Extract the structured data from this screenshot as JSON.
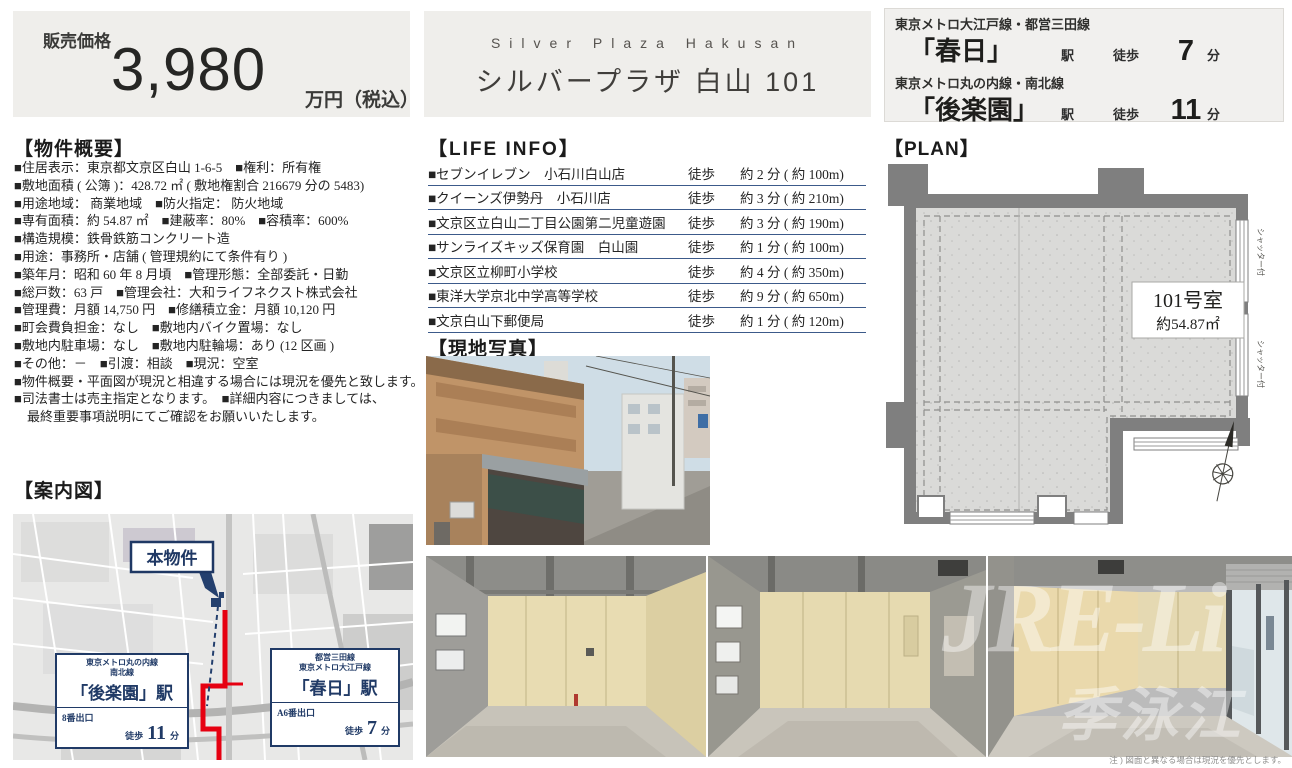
{
  "price": {
    "label": "販売価格",
    "amount": "3,980",
    "unit": "万円（税込）"
  },
  "title": {
    "en": "Silver Plaza Hakusan",
    "ja": "シルバープラザ 白山 101"
  },
  "access": [
    {
      "line": "東京メトロ大江戸線・都営三田線",
      "station": "「春日」",
      "eki": "駅",
      "walk": "徒歩",
      "minutes": "7",
      "unit": "分"
    },
    {
      "line": "東京メトロ丸の内線・南北線",
      "station": "「後楽園」",
      "eki": "駅",
      "walk": "徒歩",
      "minutes": "11",
      "unit": "分"
    }
  ],
  "outline": {
    "heading": "【物件概要】",
    "lines": [
      "■住居表示：東京都文京区白山 1-6-5　■権利：所有権",
      "■敷地面積 ( 公簿 )：428.72 ㎡ ( 敷地権割合 216679 分の 5483)",
      "■用途地域： 商業地域　■防火指定： 防火地域",
      "■専有面積：約 54.87 ㎡　■建蔽率：80%　■容積率：600%",
      "■構造規模：鉄骨鉄筋コンクリート造",
      "■用途：事務所・店舗 ( 管理規約にて条件有り )",
      "■築年月：昭和 60 年 8 月頃　■管理形態：全部委託・日勤",
      "■総戸数：63 戸　■管理会社：大和ライフネクスト株式会社",
      "■管理費：月額 14,750 円　■修繕積立金：月額 10,120 円",
      "■町会費負担金：なし　■敷地内バイク置場：なし",
      "■敷地内駐車場：なし　■敷地内駐輪場：あり (12 区画 )",
      "■その他：－　■引渡：相談　■現況：空室",
      "■物件概要・平面図が現況と相違する場合には現況を優先と致します。",
      "■司法書士は売主指定となります。　■詳細内容につきましては、",
      "　最終重要事項説明にてご確認をお願いいたします。"
    ]
  },
  "life_info": {
    "heading": "【LIFE INFO】",
    "rows": [
      {
        "name": "■セブンイレブン　小石川白山店",
        "walk": "徒歩",
        "time": "約 2 分 ( 約 100m)"
      },
      {
        "name": "■クイーンズ伊勢丹　小石川店",
        "walk": "徒歩",
        "time": "約 3 分 ( 約 210m)"
      },
      {
        "name": "■文京区立白山二丁目公園第二児童遊園",
        "walk": "徒歩",
        "time": "約 3 分 ( 約 190m)"
      },
      {
        "name": "■サンライズキッズ保育園　白山園",
        "walk": "徒歩",
        "time": "約 1 分 ( 約 100m)"
      },
      {
        "name": "■文京区立柳町小学校",
        "walk": "徒歩",
        "time": "約 4 分 ( 約 350m)"
      },
      {
        "name": "■東洋大学京北中学高等学校",
        "walk": "徒歩",
        "time": "約 9 分 ( 約 650m)"
      },
      {
        "name": "■文京白山下郵便局",
        "walk": "徒歩",
        "time": "約 1 分 ( 約 120m)"
      }
    ]
  },
  "photos": {
    "heading": "【現地写真】",
    "watermark_latin": "JRE-Li",
    "watermark_cjk": "季泳江",
    "caption": "注 ) 図面と異なる場合は現況を優先とします。"
  },
  "plan": {
    "heading": "【PLAN】",
    "room_label": "101号室",
    "room_area": "約54.87㎡",
    "shutter_label": "シャッター付"
  },
  "map": {
    "heading": "【案内図】",
    "property_label": "本物件",
    "stations": [
      {
        "line1": "東京メトロ丸の内線",
        "line2": "南北線",
        "name": "「後楽園」駅",
        "exit": "8番出口",
        "walk": "徒歩",
        "minutes": "11",
        "unit": "分"
      },
      {
        "line1": "都営三田線",
        "line2": "東京メトロ大江戸線",
        "name": "「春日」駅",
        "exit": "A6番出口",
        "walk": "徒歩",
        "minutes": "7",
        "unit": "分"
      }
    ]
  },
  "colors": {
    "navy": "#203a66",
    "route_red": "#e60011",
    "box_bg": "#efeeeb",
    "rule_blue": "#3c5a8a"
  }
}
